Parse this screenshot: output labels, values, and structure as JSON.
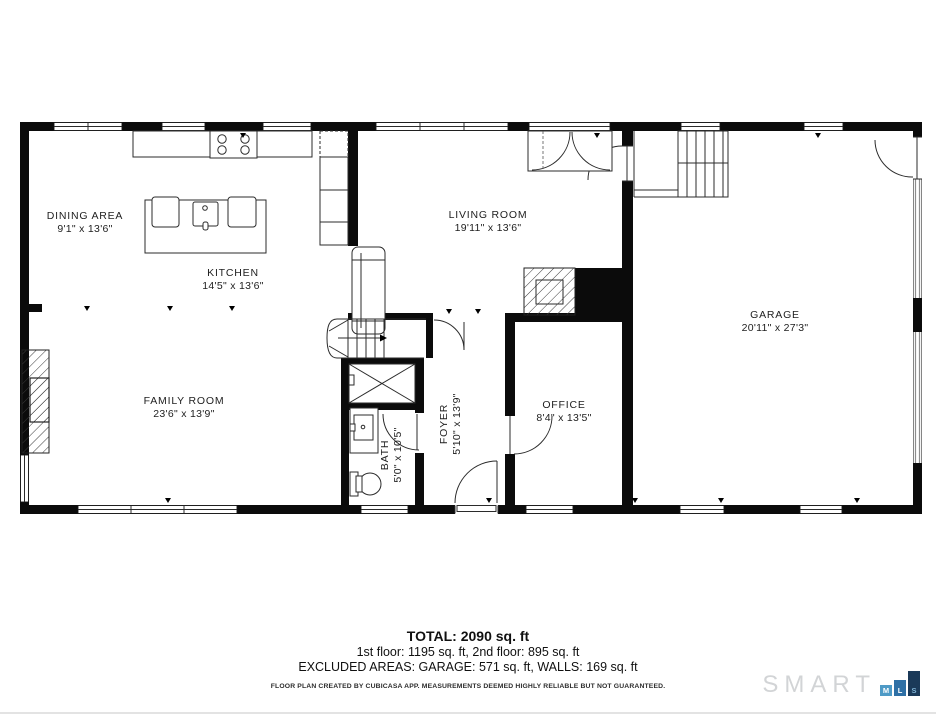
{
  "plan": {
    "rooms": {
      "dining": {
        "name": "DINING AREA",
        "dims": "9'1\" x 13'6\""
      },
      "kitchen": {
        "name": "KITCHEN",
        "dims": "14'5\" x 13'6\""
      },
      "living": {
        "name": "LIVING ROOM",
        "dims": "19'11\" x 13'6\""
      },
      "garage": {
        "name": "GARAGE",
        "dims": "20'11\" x 27'3\""
      },
      "family": {
        "name": "FAMILY ROOM",
        "dims": "23'6\" x 13'9\""
      },
      "bath": {
        "name": "BATH",
        "dims": "5'0\" x 10'5\""
      },
      "foyer": {
        "name": "FOYER",
        "dims": "5'10\" x 13'9\""
      },
      "office": {
        "name": "OFFICE",
        "dims": "8'4\" x 13'5\""
      }
    }
  },
  "summary": {
    "total": "TOTAL: 2090 sq. ft",
    "floors": "1st floor: 1195 sq. ft, 2nd floor: 895 sq. ft",
    "excluded": "EXCLUDED AREAS: GARAGE: 571 sq. ft, WALLS: 169 sq. ft",
    "disclaimer": "FLOOR PLAN CREATED BY CUBICASA APP. MEASUREMENTS DEEMED HIGHLY RELIABLE BUT NOT GUARANTEED."
  },
  "logo": {
    "brand": "SMART",
    "mls": [
      "M",
      "L",
      "S"
    ],
    "colors": {
      "brand": "#d2d4d6",
      "m": "#4e9ac6",
      "l": "#2e70a6",
      "s": "#1b3a59"
    }
  }
}
